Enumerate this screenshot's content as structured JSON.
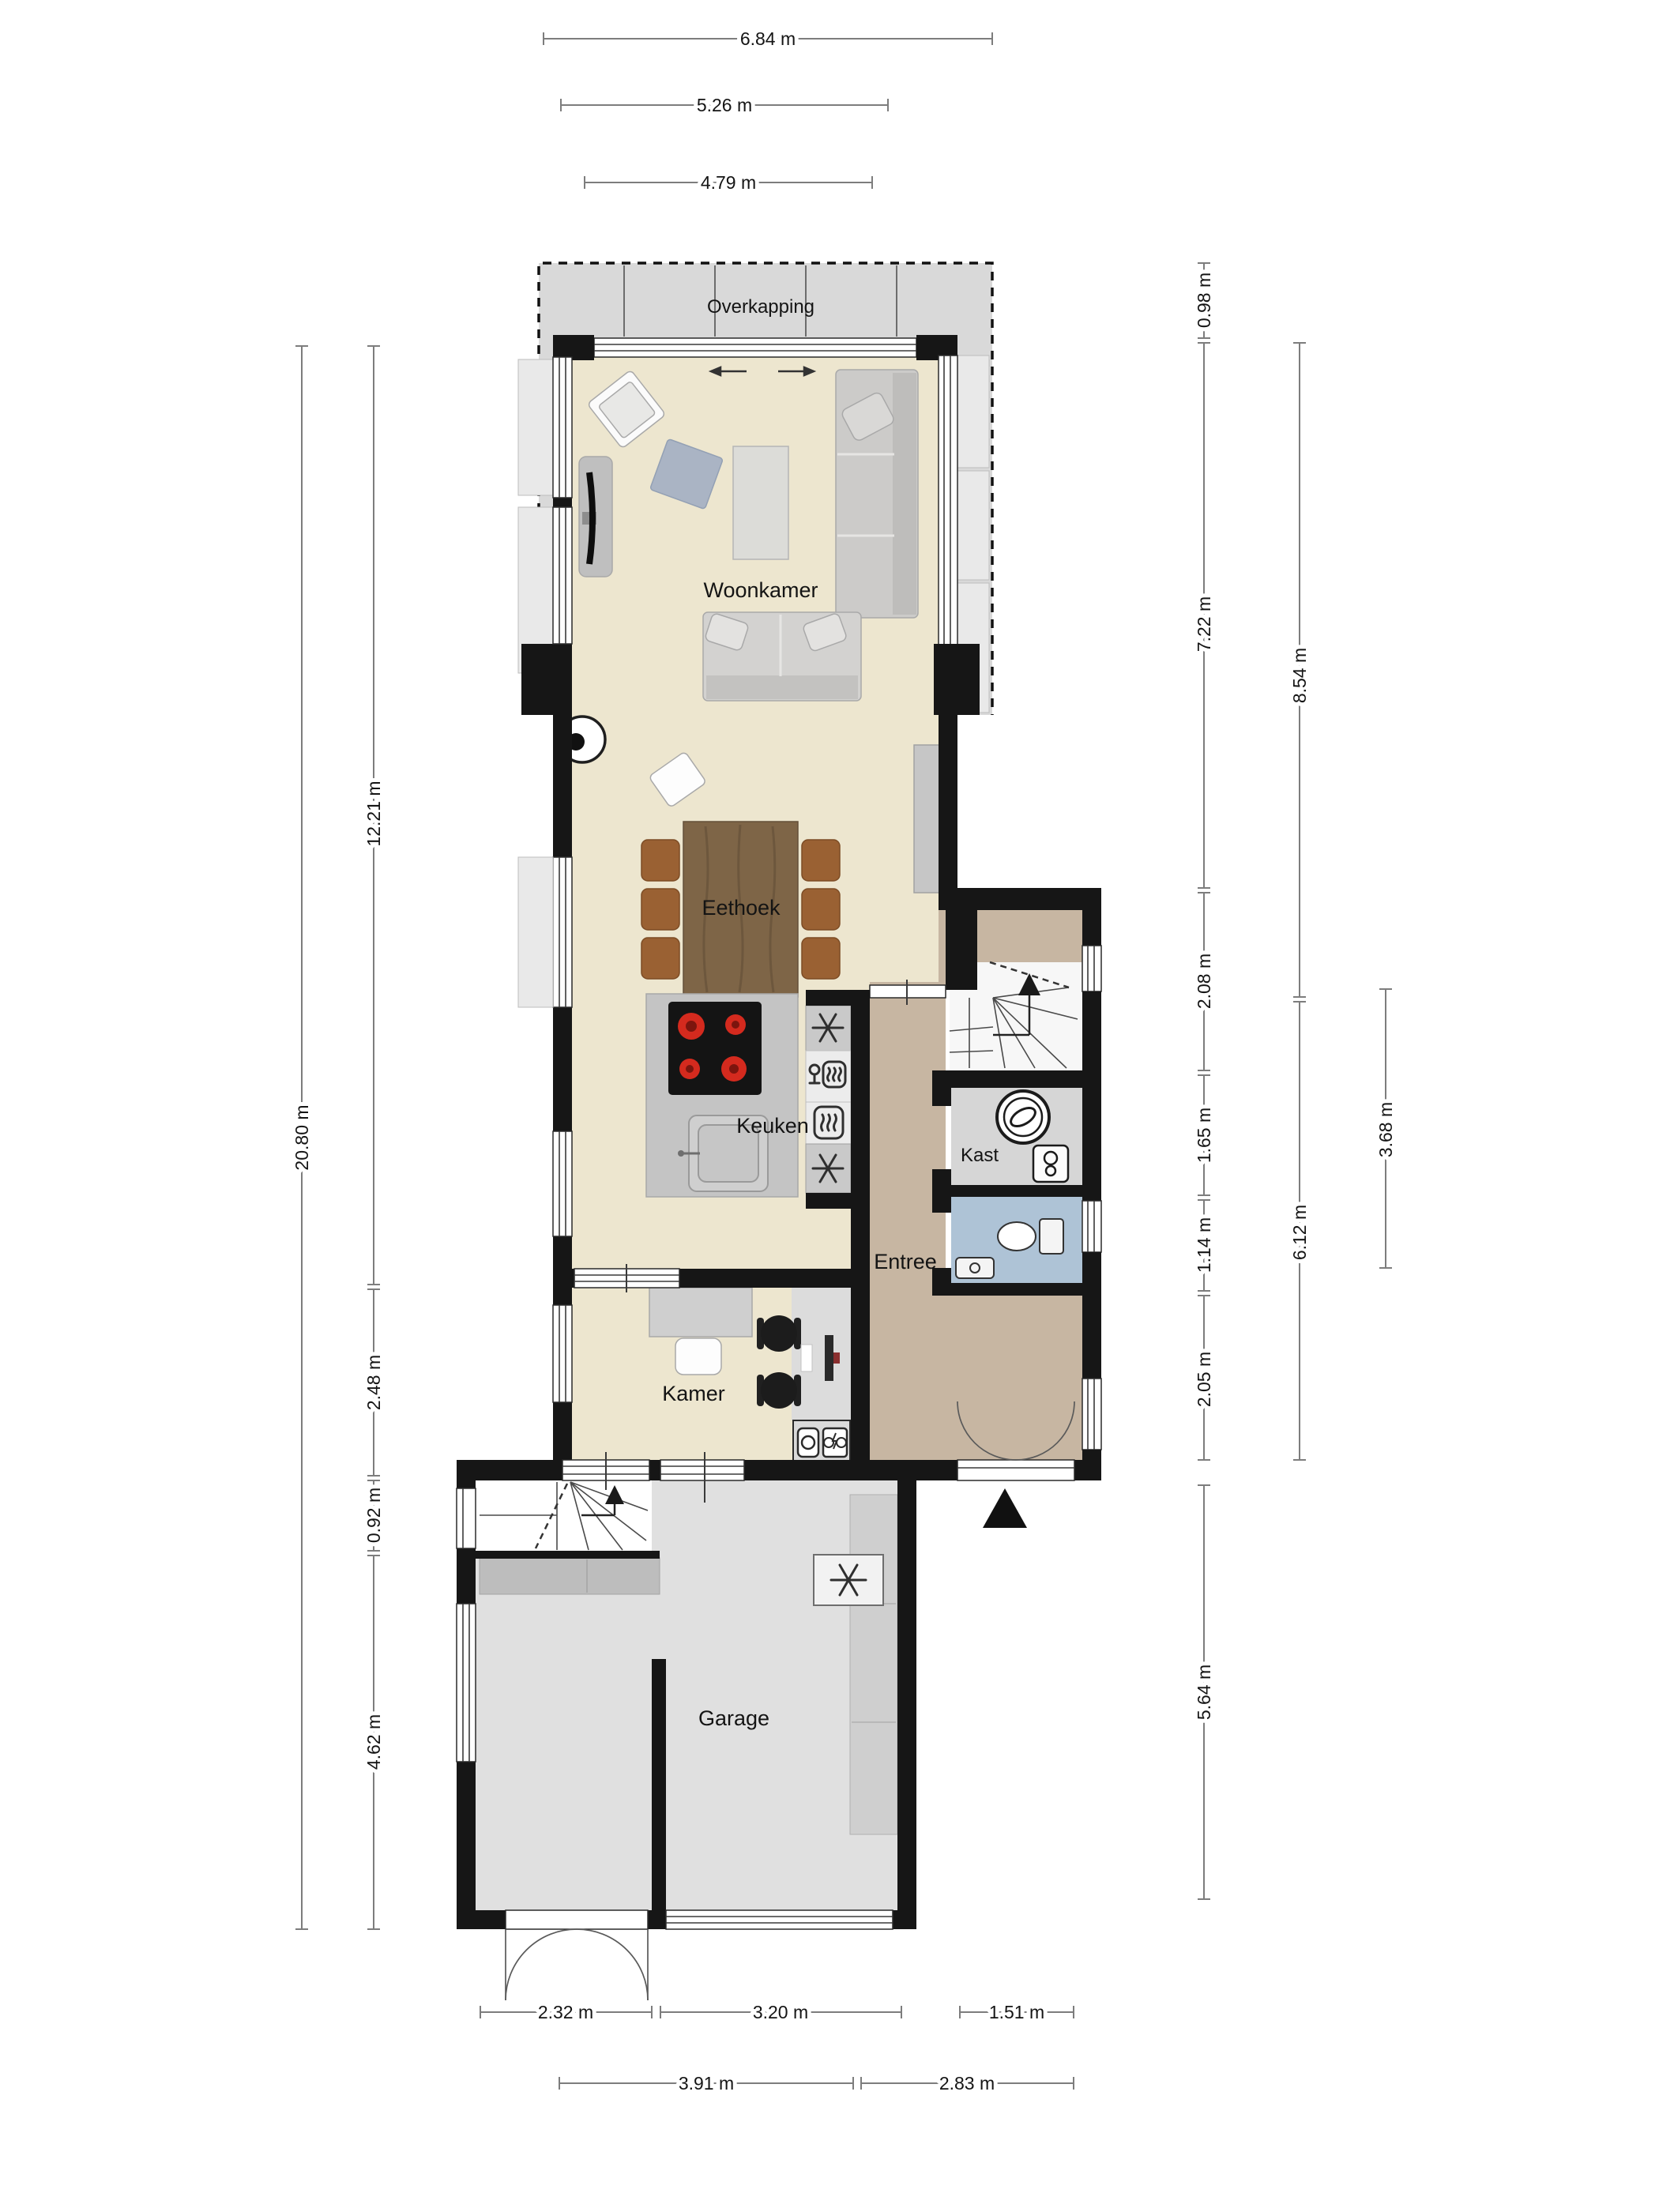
{
  "plan": {
    "type": "floorplan",
    "language": "nl",
    "rooms": {
      "overkapping": "Overkapping",
      "woonkamer": "Woonkamer",
      "eethoek": "Eethoek",
      "keuken": "Keuken",
      "kast": "Kast",
      "entree": "Entree",
      "kamer": "Kamer",
      "garage": "Garage"
    },
    "dims": {
      "top": [
        "6.84 m",
        "5.26 m",
        "4.79 m"
      ],
      "bottom_row1": [
        "2.32 m",
        "3.20 m",
        "1.51 m"
      ],
      "bottom_row2": [
        "3.91 m",
        "2.83 m"
      ],
      "left": [
        "20.80 m",
        "12.21 m",
        "2.48 m",
        "0.92 m",
        "4.62 m"
      ],
      "right": [
        "0.98 m",
        "7.22 m",
        "8.54 m",
        "2.08 m",
        "1.65 m",
        "1.14 m",
        "2.05 m",
        "6.12 m",
        "3.68 m",
        "5.64 m"
      ]
    },
    "colors": {
      "wall": "#161616",
      "floor_living": "#ede6cf",
      "floor_entree": "#c7b6a2",
      "floor_wc": "#aec3d6",
      "floor_kast": "#d6d6d6",
      "floor_garage": "#e0e0e0",
      "overkapping": "#d9d9d9",
      "table_wood": "#7e6547",
      "dining_chair": "#9a6133",
      "hob_burner": "#d42a1e",
      "dim_line": "#7d7d7d"
    }
  }
}
